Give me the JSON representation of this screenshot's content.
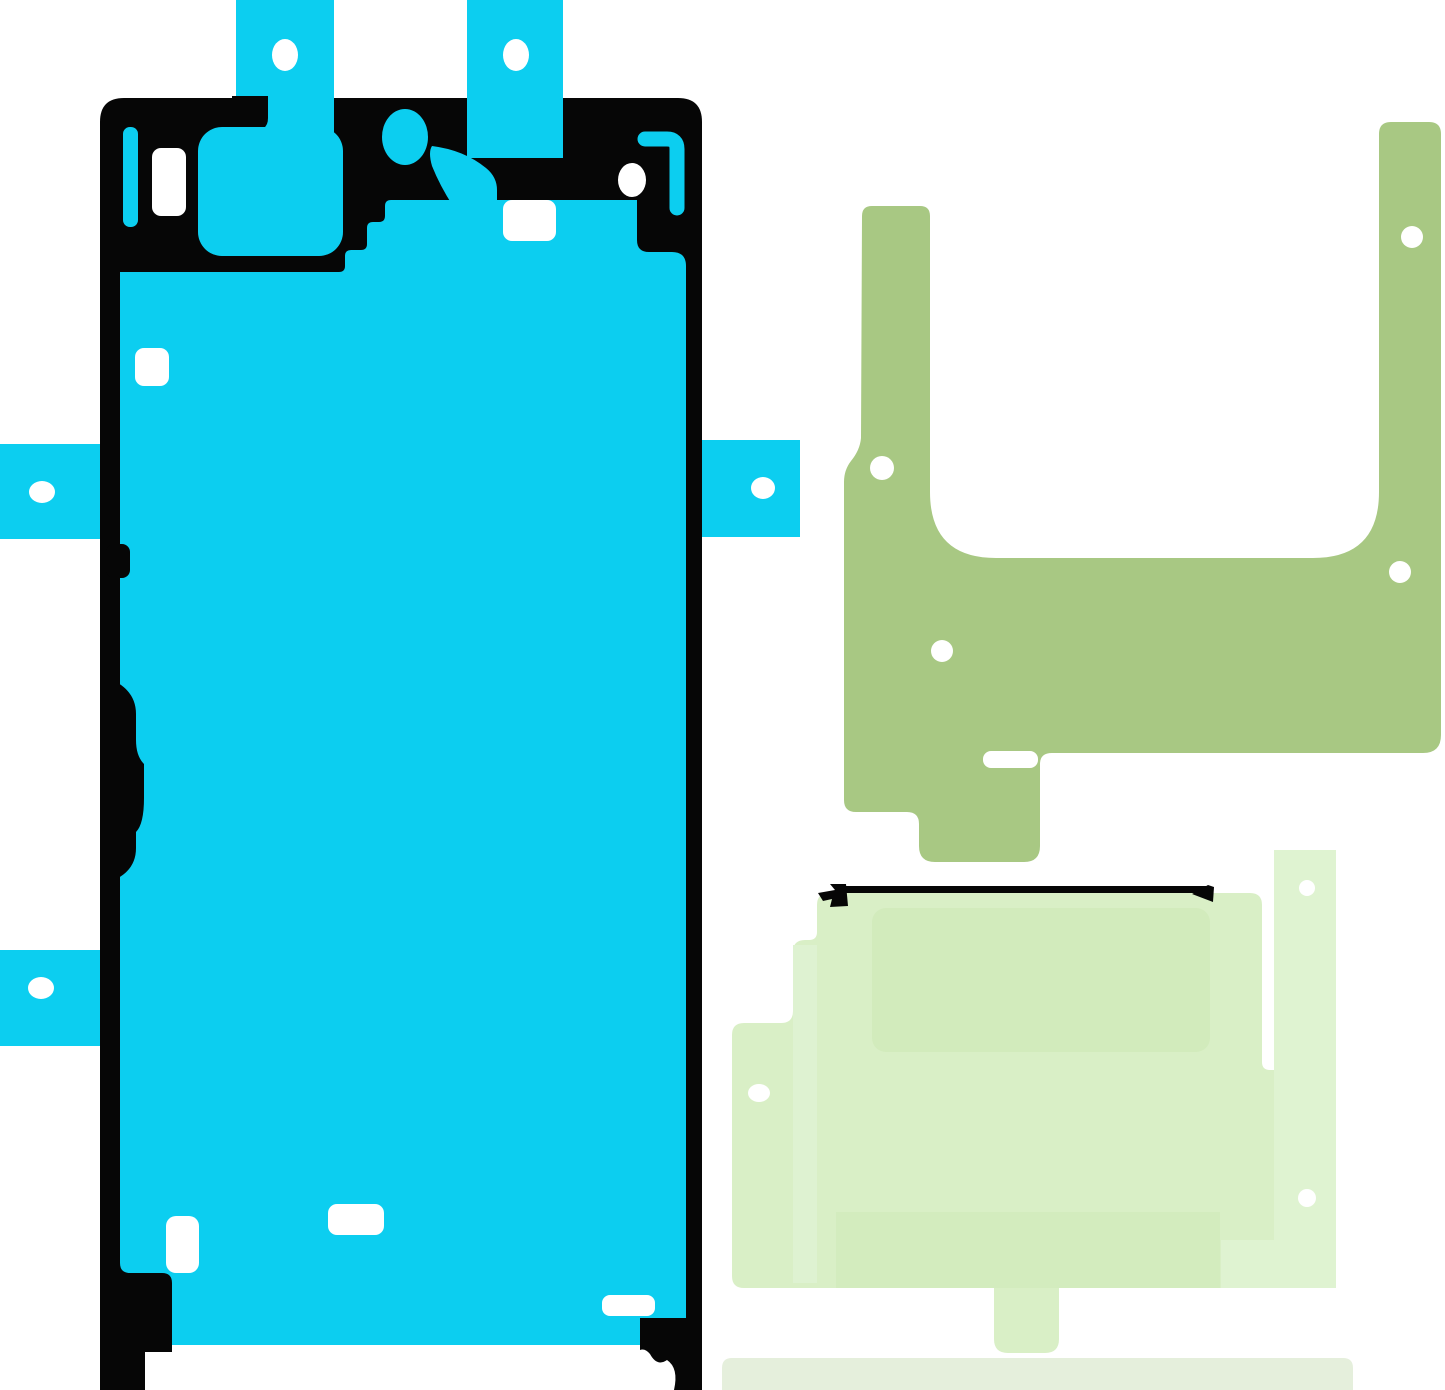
{
  "image": {
    "title": "Adhesive sticker set for smartphone display repair",
    "background": "#ffffff"
  },
  "colors": {
    "cyan": "#0CCEF0",
    "black": "#060606",
    "olive": "#A8C883",
    "light_green": "#D9EFC6",
    "light_green_inner": "#D2EBBC",
    "light_green_lighter": "#DFF3D1",
    "light_green_band": "#D3ECBE",
    "left_strip": "#DEF2D1",
    "bottom_strip": "#E5EFDC",
    "hole": "#FFFFFF",
    "background": "#FFFFFF"
  },
  "pieces": [
    {
      "id": "display-frame-adhesive",
      "description": "large cyan screen gasket with five pull tabs and alignment holes",
      "color_ref": "cyan",
      "tab_count": 5,
      "hole_count": 5
    },
    {
      "id": "bracket-adhesive",
      "description": "olive green U-shaped adhesive with four alignment holes",
      "color_ref": "olive",
      "hole_count": 4
    },
    {
      "id": "sheet-adhesive",
      "description": "pale green layered adhesive sheet with three alignment holes and black liner line",
      "color_ref": "light_green",
      "hole_count": 3
    },
    {
      "id": "bottom-strip-adhesive",
      "description": "pale grey-green strip",
      "color_ref": "bottom_strip",
      "hole_count": 0
    }
  ]
}
